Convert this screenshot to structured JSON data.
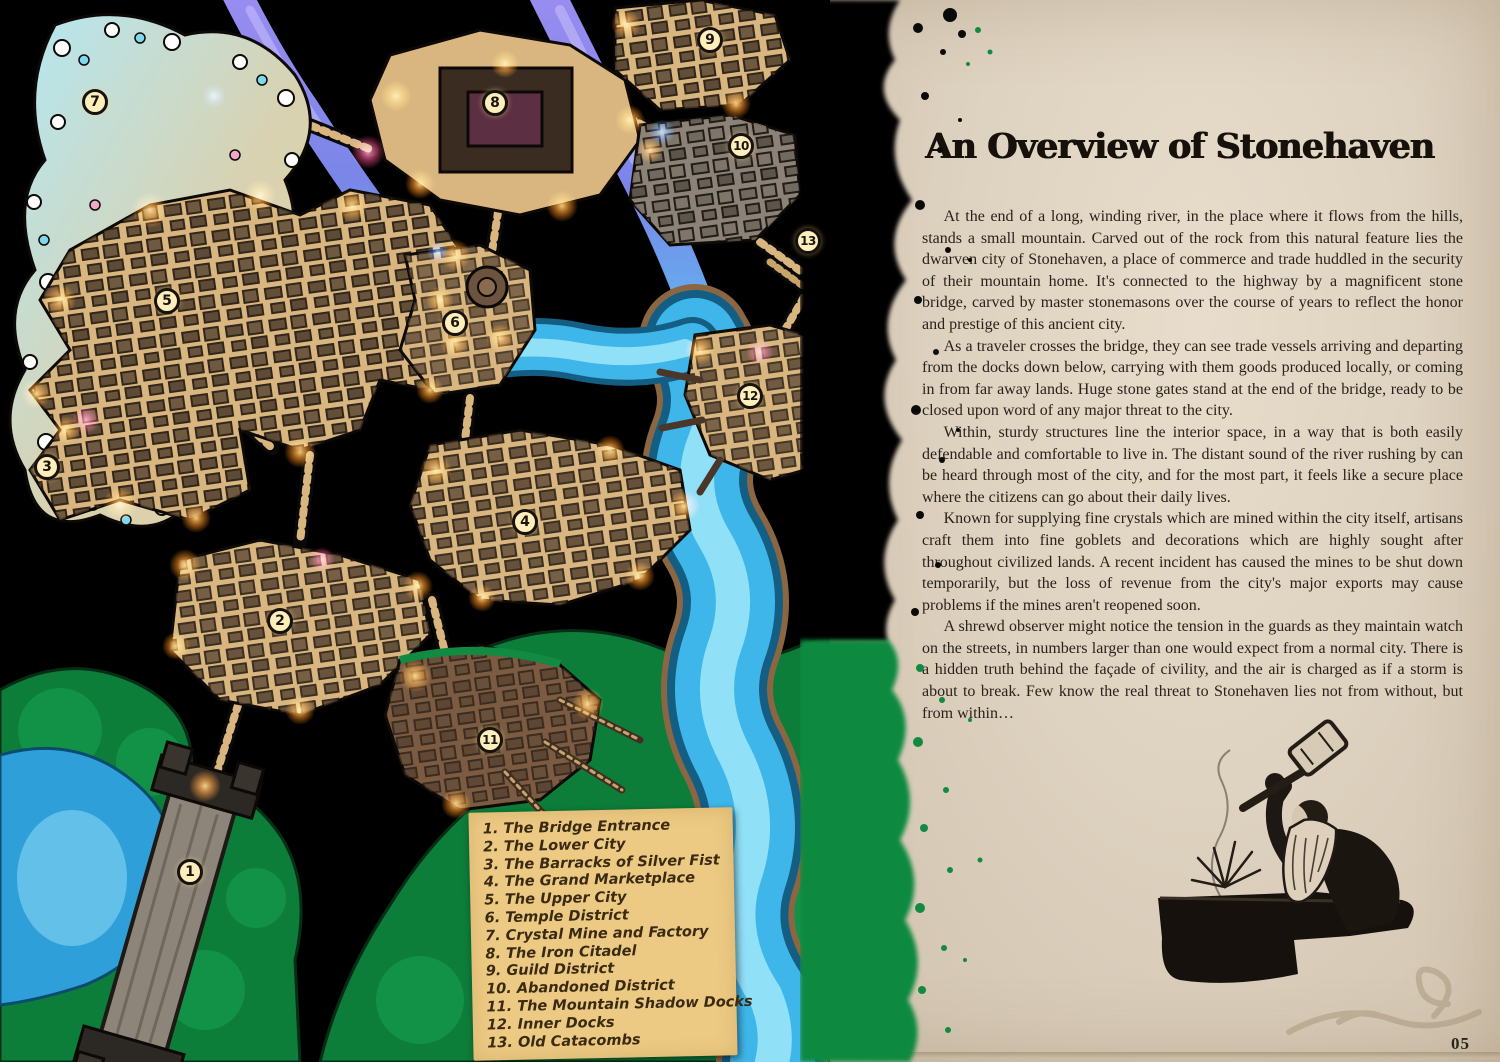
{
  "page": {
    "title": "An Overview of Stonehaven",
    "number": "05",
    "paragraphs": [
      "At the end of a long, winding river, in the place where it flows from the hills, stands a small mountain. Carved out of the rock from this natural feature lies the dwarven city of Stonehaven, a place of commerce and trade huddled in the security of their mountain home. It's connected to the highway by a magnificent stone bridge, carved by master stonemasons over the course of years to reflect the honor and prestige of this ancient city.",
      "As a traveler crosses the bridge, they can see trade vessels arriving and departing from the docks down below, carrying with them goods produced locally, or coming in from far away lands. Huge stone gates stand at the end of the bridge, ready to be closed upon word of any major threat to the city.",
      "Within, sturdy structures line the interior space, in a way that is both easily defendable and comfortable to live in. The distant sound of the river rushing by can be heard through most of the city, and for the most part, it feels like a secure place where the citizens can go about their daily lives.",
      "Known for supplying fine crystals which are mined within the city itself, artisans craft them into fine goblets and decorations which are highly sought after throughout civilized lands. A recent incident has caused the mines to be shut down temporarily, but the loss of revenue from the city's major exports may cause problems if the mines aren't reopened soon.",
      "A shrewd observer might notice the tension in the guards as they maintain watch on the streets, in numbers larger than one would expect from a normal city. There is a hidden truth behind the façade of civility, and the air is charged as if a storm is about to break. Few know the real threat to Stonehaven lies not from without, but from within…"
    ]
  },
  "map": {
    "markers": [
      {
        "num": "1",
        "name": "The Bridge Entrance",
        "legend": "1. The Bridge Entrance"
      },
      {
        "num": "2",
        "name": "The Lower City",
        "legend": "2. The Lower City"
      },
      {
        "num": "3",
        "name": "The Barracks of Silver Fist",
        "legend": "3. The Barracks of Silver Fist"
      },
      {
        "num": "4",
        "name": "The Grand Marketplace",
        "legend": "4. The Grand Marketplace"
      },
      {
        "num": "5",
        "name": "The Upper City",
        "legend": "5. The Upper City"
      },
      {
        "num": "6",
        "name": "Temple District",
        "legend": "6. Temple District"
      },
      {
        "num": "7",
        "name": "Crystal Mine and Factory",
        "legend": "7. Crystal Mine and Factory"
      },
      {
        "num": "8",
        "name": "The Iron Citadel",
        "legend": "8. The Iron Citadel"
      },
      {
        "num": "9",
        "name": "Guild District",
        "legend": "9. Guild District"
      },
      {
        "num": "10",
        "name": "Abandoned District",
        "legend": "10. Abandoned District"
      },
      {
        "num": "11",
        "name": "The Mountain Shadow Docks",
        "legend": "11. The Mountain Shadow Docks"
      },
      {
        "num": "12",
        "name": "Inner Docks",
        "legend": "12. Inner Docks"
      },
      {
        "num": "13",
        "name": "Old Catacombs",
        "legend": "13. Old Catacombs"
      }
    ],
    "colors": {
      "map_background": "#000000",
      "district_tan": "#d9b57f",
      "river_cyan": "#3fb6ea",
      "river_purple": "#8b7ce8",
      "terrain_green": "#0d7d3a",
      "glow_orange": "#ff9a2e",
      "marker_bg": "#fdeebc",
      "legend_bg": "#ecca84",
      "parchment": "#ded2c0"
    }
  },
  "illustration": {
    "name": "dwarf-blacksmith-striking-anvil"
  }
}
